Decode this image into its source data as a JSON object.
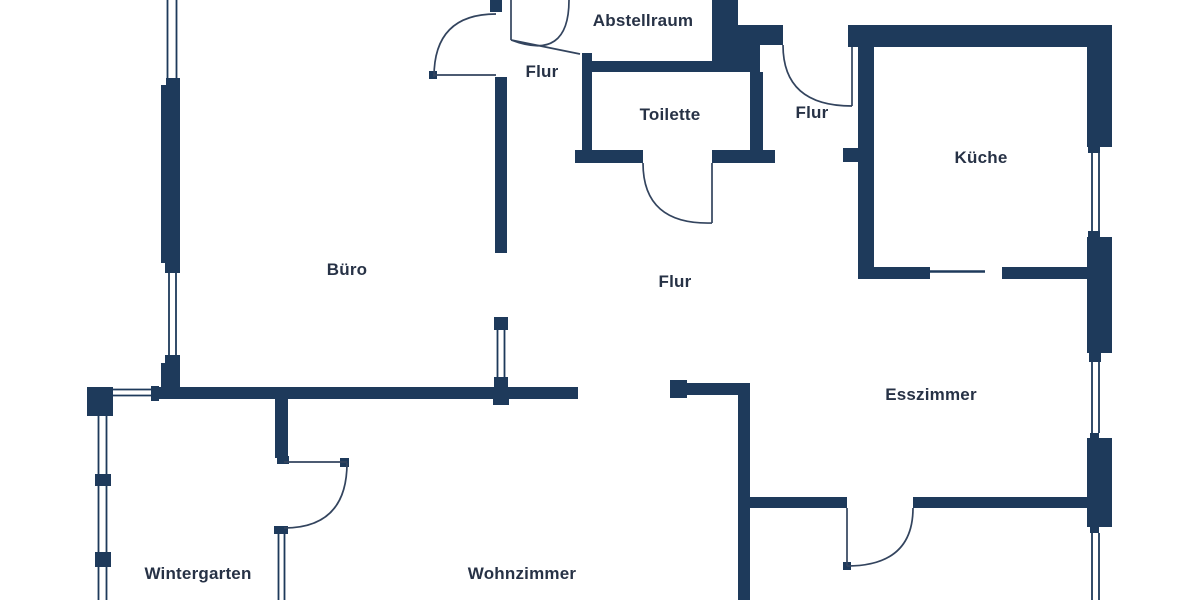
{
  "colors": {
    "wall": "#1e3a5b",
    "door_line": "#33445e",
    "text": "#273246",
    "background": "#ffffff"
  },
  "rooms": [
    {
      "id": "abstellraum",
      "label": "Abstellraum"
    },
    {
      "id": "flur-top",
      "label": "Flur"
    },
    {
      "id": "toilette",
      "label": "Toilette"
    },
    {
      "id": "flur-right",
      "label": "Flur"
    },
    {
      "id": "kueche",
      "label": "Küche"
    },
    {
      "id": "buero",
      "label": "Büro"
    },
    {
      "id": "flur-center",
      "label": "Flur"
    },
    {
      "id": "esszimmer",
      "label": "Esszimmer"
    },
    {
      "id": "wintergarten",
      "label": "Wintergarten"
    },
    {
      "id": "wohnzimmer",
      "label": "Wohnzimmer"
    }
  ]
}
